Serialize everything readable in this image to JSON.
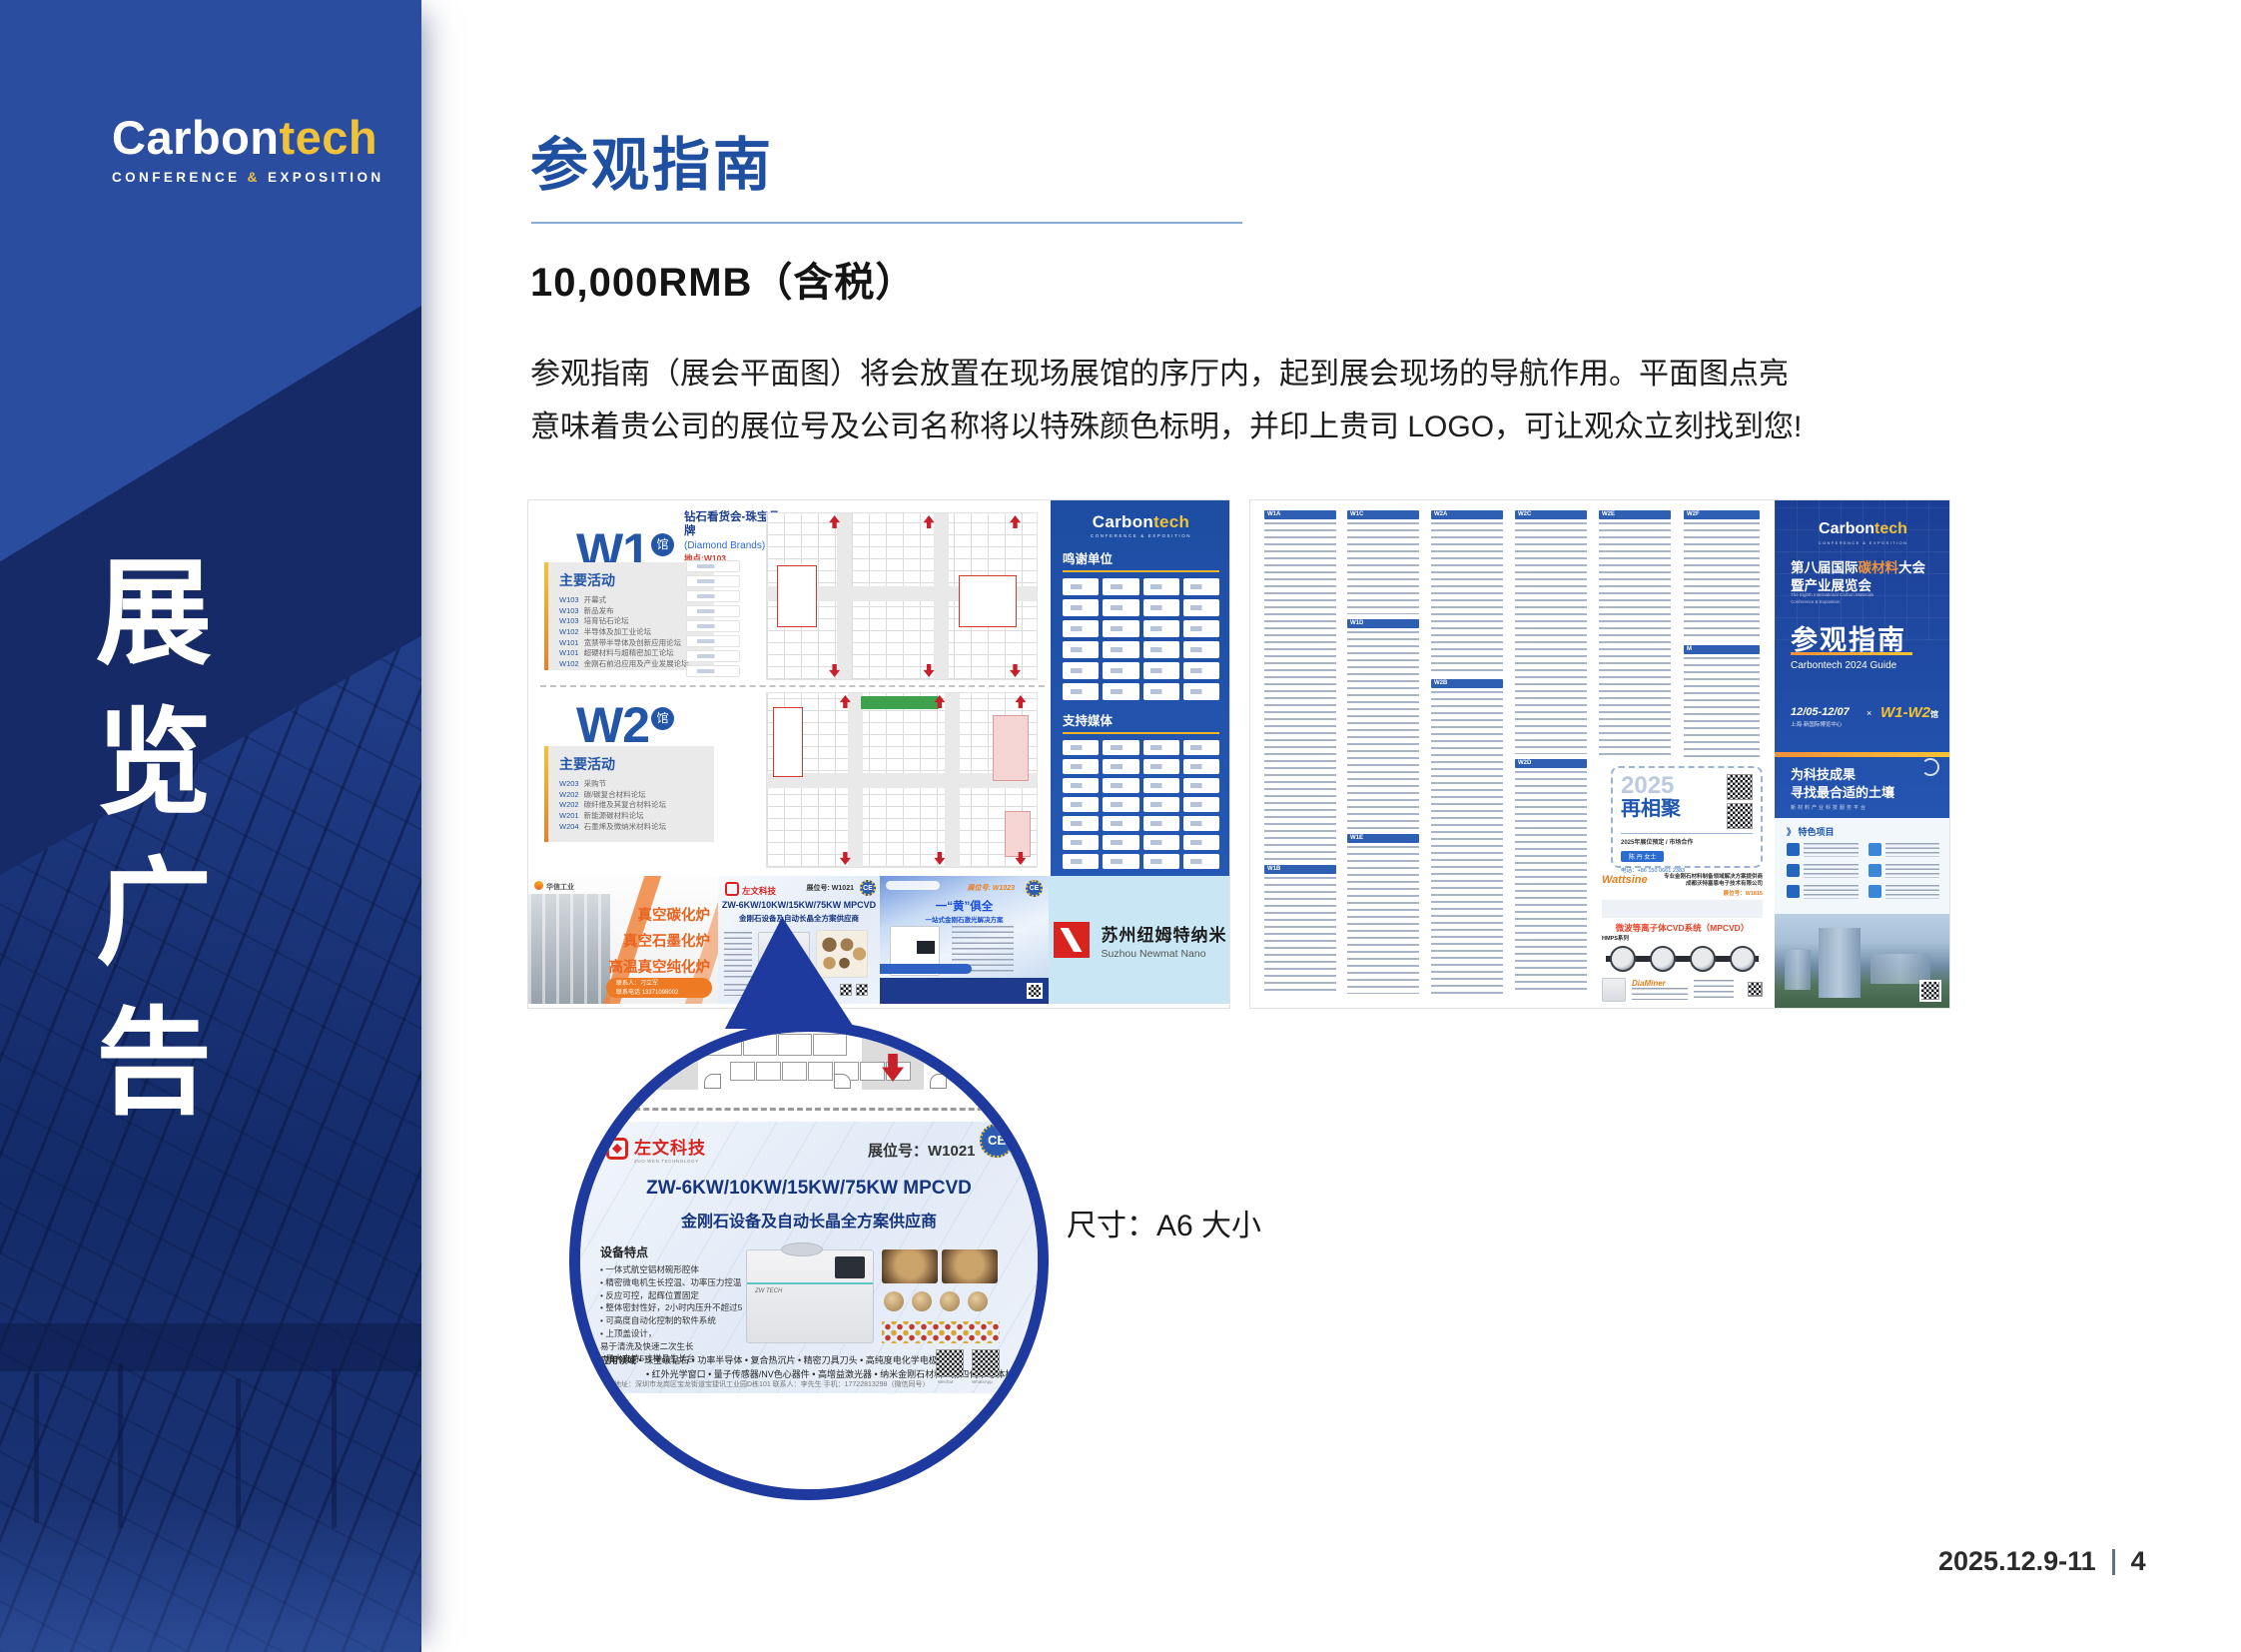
{
  "sidebar": {
    "logo": {
      "brand_white": "Carbon",
      "brand_yellow": "tech",
      "sub_left": "CONFERENCE ",
      "sub_amp": "&",
      "sub_right": " EXPOSITION"
    },
    "vertical_title": "展览广告"
  },
  "header": {
    "title": "参观指南",
    "price": "10,000RMB（含税）",
    "desc_line1": "参观指南（展会平面图）将会放置在现场展馆的序厅内，起到展会现场的导航作用。平面图点亮",
    "desc_line2": "意味着贵公司的展位号及公司名称将以特殊颜色标明，并印上贵司 LOGO，可让观众立刻找到您!"
  },
  "brochure_left": {
    "w1": {
      "hall": "W1",
      "hall_suffix": "馆",
      "section_title": "主要活动",
      "events": [
        {
          "code": "W103",
          "name": "开幕式"
        },
        {
          "code": "W103",
          "name": "新品发布"
        },
        {
          "code": "W103",
          "name": "培育钻石论坛"
        },
        {
          "code": "W102",
          "name": "半导体及加工业论坛"
        },
        {
          "code": "W101",
          "name": "宽禁带半导体及创新应用论坛"
        },
        {
          "code": "W101",
          "name": "超硬材料与超精密加工论坛"
        },
        {
          "code": "W102",
          "name": "金刚石前沿应用及产业发展论坛"
        }
      ]
    },
    "w2": {
      "hall": "W2",
      "hall_suffix": "馆",
      "section_title": "主要活动",
      "events": [
        {
          "code": "W203",
          "name": "采购节"
        },
        {
          "code": "W202",
          "name": "碳/碳复合材料论坛"
        },
        {
          "code": "W202",
          "name": "碳纤维及其复合材料论坛"
        },
        {
          "code": "W201",
          "name": "新能源碳材料论坛"
        },
        {
          "code": "W204",
          "name": "石墨烯及微纳米材料论坛"
        }
      ]
    },
    "diamond": {
      "line1": "钻石看货会-珠宝品牌",
      "line2": "(Diamond Brands)",
      "line3": "地点:W103"
    },
    "panel": {
      "logo_white": "Carbon",
      "logo_yellow": "tech",
      "logo_sub": "CONFERENCE & EXPOSITION",
      "sponsors_title": "鸣谢单位",
      "media_title": "支持媒体"
    },
    "ads": {
      "huaxin": {
        "brand": "华信工业",
        "l1": "真空碳化炉",
        "l2": "真空石墨化炉",
        "l3": "高温真空纯化炉",
        "contact": "联系人：刁立军",
        "phone": "联系电话 13371098002"
      },
      "zw": {
        "brand": "左文科技",
        "booth": "展位号: W1021",
        "ce": "CE",
        "headline": "ZW-6KW/10KW/15KW/75KW MPCVD",
        "subline": "金刚石设备及自动长晶全方案供应商"
      },
      "laser": {
        "booth": "展位号: W1023",
        "ce": "CE",
        "headline": "一“黄”俱全",
        "subline": "一站式金刚石激光解决方案"
      },
      "newmat": {
        "cn": "苏州纽姆特纳米",
        "en": "Suzhou Newmat Nano"
      }
    }
  },
  "brochure_right": {
    "headers": [
      "W1A",
      "W1B",
      "W1C",
      "W1D",
      "W1E",
      "W2A",
      "W2B",
      "W2C",
      "W2D",
      "W2E",
      "W2F",
      "M"
    ],
    "reunion": {
      "year": "2025",
      "title": "再相聚",
      "line": "2025年展位预定 / 市场合作",
      "contact": "陈 丹 女士",
      "phone": "电话：+86 150 0661 2383",
      "email": "邮箱：Vicky@polydt.com"
    },
    "wattsine": {
      "brand": "Wattsine",
      "line1": "专业金刚石材料制备领域解决方案提供商",
      "line2": "成都沃特塞恩电子技术有限公司",
      "booth": "展位号：W1815",
      "product": "微波等离子体CVD系统（MPCVD）",
      "series": "HMPS系列",
      "series2": "DiaMiner"
    },
    "cover": {
      "logo_white": "Carbon",
      "logo_yellow": "tech",
      "logo_sub": "CONFERENCE & EXPOSITION",
      "t1a": "第八届国际",
      "t1b": "碳材料",
      "t1c": "大会",
      "t2": "暨产业展览会",
      "en1": "The Eighth International Carbon Materials",
      "en2": "Conference & Exposition",
      "guide": "参观指南",
      "guide_en": "Carbontech 2024 Guide",
      "date": "12/05-12/07",
      "venue": "上海·新国际博览中心",
      "x": "×",
      "halls": "W1-W2",
      "halls_suffix": "馆",
      "slogan1": "为科技成果",
      "slogan2": "寻找最合适的土壤",
      "slogan3": "新材料产业科技服务平台",
      "features_arrow": "》",
      "features_title": "特色项目"
    }
  },
  "magnifier": {
    "brand": "左文科技",
    "brand_sub": "ZUO WEN TECHNOLOGY",
    "booth_label": "展位号：W1021",
    "ce": "CE",
    "headline": "ZW-6KW/10KW/15KW/75KW MPCVD",
    "subline": "金刚石设备及自动长晶全方案供应商",
    "machine_label": "ZW TECH",
    "features_title": "设备特点",
    "features": [
      "• 一体式航空铝材碗形腔体",
      "• 精密微电机生长控温、功率压力控温",
      "• 反应可控，起辉位置固定",
      "• 整体密封性好，2小时内压升不超过5pa",
      "• 可高度自动化控制的软件系统",
      "• 上顶盖设计，",
      "  易于清洗及快速二次生长",
      "• 最大支持5寸样品生长台"
    ],
    "apps_label": "应用领域",
    "apps1": "• 珠宝级钻石  • 功率半导体  • 复合热沉片  • 精密刀具刀头  • 高纯度电化学电极",
    "apps2": "• 红外光学窗口  • 量子传感器/NV色心器件  • 高增益激光器  • 纳米金刚石材料  • 第四代半导体材料",
    "address": "深圳地址：深圳市龙岗区宝龙街道宝捷讯工业园D栋101    联系人：李先生 手机：17722813298（微信同号）",
    "qr1": "Wechat",
    "qr2": "WhatsApp"
  },
  "caption": "尺寸：A6 大小",
  "footer": {
    "date": "2025.12.9-11",
    "sep": "",
    "page": "4"
  }
}
